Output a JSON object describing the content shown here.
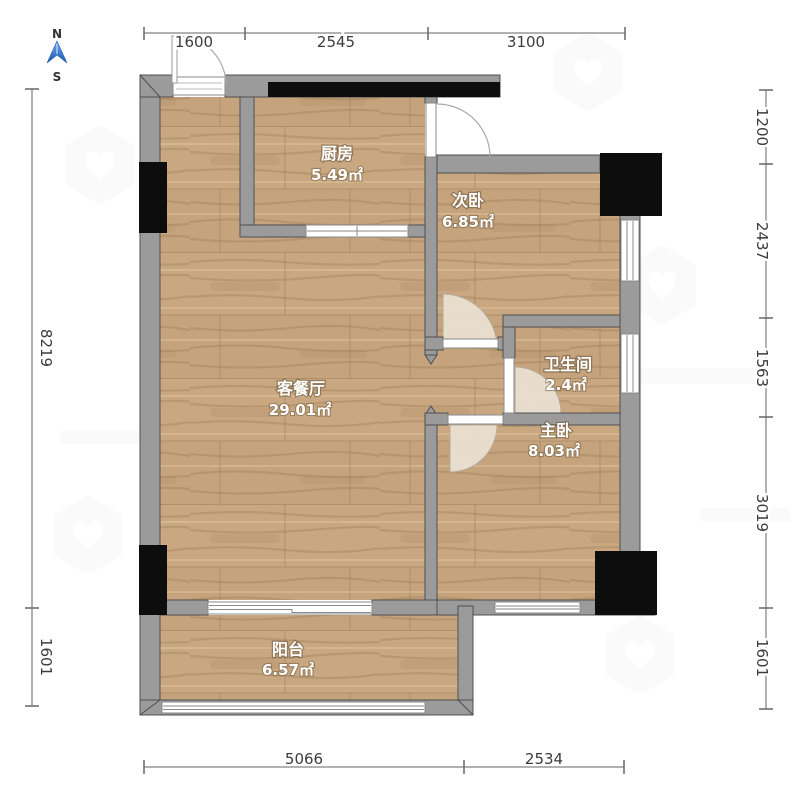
{
  "title": "apartment-floor-plan",
  "compass": {
    "north": "N",
    "south": "S"
  },
  "rooms": {
    "kitchen": {
      "name": "厨房",
      "area": "5.49㎡"
    },
    "second_bedroom": {
      "name": "次卧",
      "area": "6.85㎡"
    },
    "living_dining": {
      "name": "客餐厅",
      "area": "29.01㎡"
    },
    "bathroom": {
      "name": "卫生间",
      "area": "2.4㎡"
    },
    "master_bedroom": {
      "name": "主卧",
      "area": "8.03㎡"
    },
    "balcony": {
      "name": "阳台",
      "area": "6.57㎡"
    }
  },
  "dimensions": {
    "top": [
      "1600",
      "2545",
      "3100"
    ],
    "bottom": [
      "5066",
      "2534"
    ],
    "left": [
      "8219",
      "1601"
    ],
    "right": [
      "1200",
      "2437",
      "1563",
      "3019",
      "1601"
    ]
  },
  "colors": {
    "wall": "#9b9b9b",
    "wall_edge": "#4f4f4f",
    "floor_base": "#c5a37d",
    "column": "#0d0d0d",
    "window": "#ffffff",
    "door_swing_fill": "#eae2d3",
    "compass_blue": "#2f7bd0",
    "dim_line": "#666666"
  }
}
